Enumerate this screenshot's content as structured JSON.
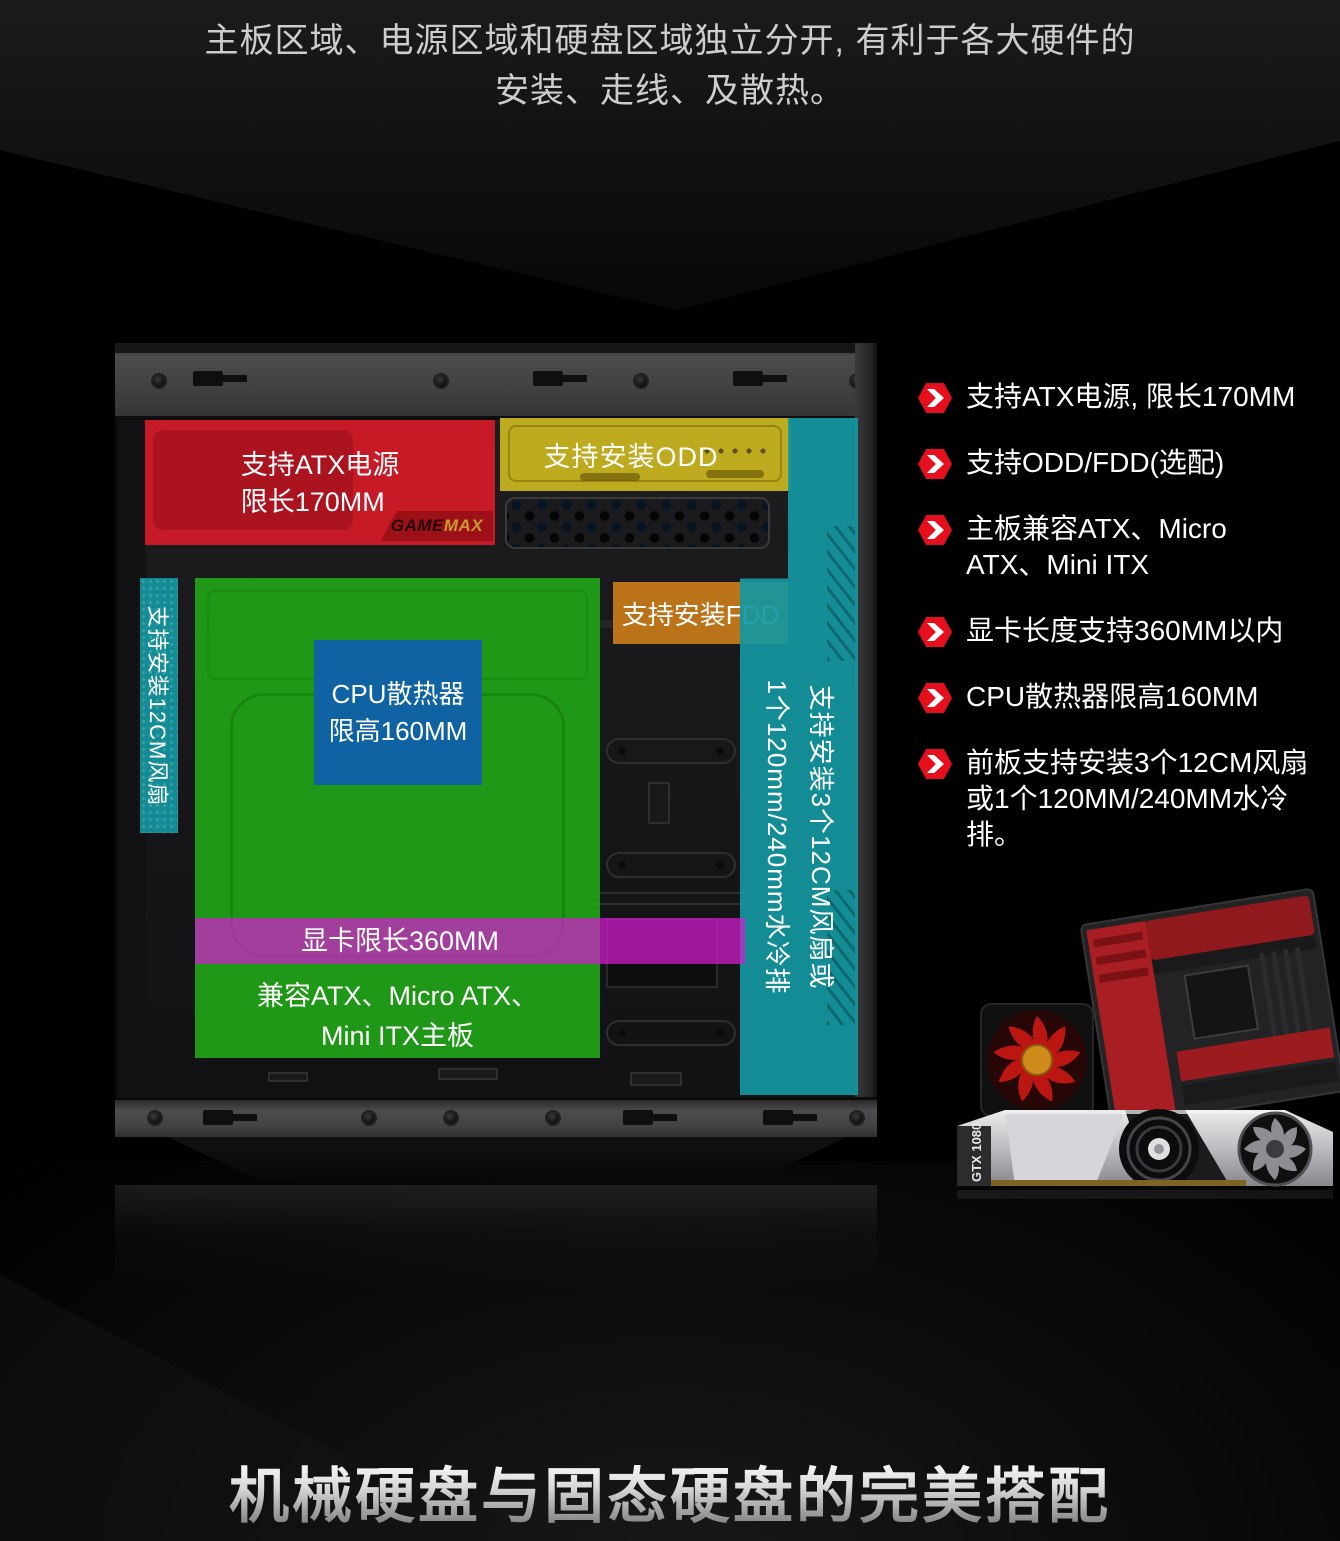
{
  "header": {
    "line1": "主板区域、电源区域和硬盘区域独立分开, 有利于各大硬件的",
    "line2": "安装、走线、及散热。"
  },
  "case_diagram": {
    "psu_region": {
      "line1": "支持ATX电源",
      "line2": "限长170MM",
      "color": "#d01a28"
    },
    "odd_region": {
      "label": "支持安装ODD",
      "color": "#cab51e"
    },
    "fdd_region": {
      "label": "支持安装FDD",
      "color": "#c4781a"
    },
    "motherboard_region": {
      "line1": "兼容ATX、Micro ATX、",
      "line2": "Mini ITX主板",
      "color": "#20a218"
    },
    "cpu_region": {
      "line1": "CPU散热器",
      "line2": "限高160MM",
      "color": "#1061a8"
    },
    "gpu_strip": {
      "label": "显卡限长360MM",
      "color": "#b32bad"
    },
    "left_fan_strip": {
      "label": "支持安装12CM风扇",
      "color": "#1497a1"
    },
    "front_fan_strip": {
      "line1": "支持安装3个12CM风扇或",
      "line2": "1个120mm/240mm水冷排",
      "color": "#1497a1"
    },
    "brand_badge": {
      "part1": "GAME",
      "part2": "MAX"
    }
  },
  "features": {
    "bullet_color": "#e50f1e",
    "items": [
      {
        "text": "支持ATX电源, 限长170MM"
      },
      {
        "text": "支持ODD/FDD(选配)"
      },
      {
        "text": "主板兼容ATX、Micro ATX、Mini ITX"
      },
      {
        "text": "显卡长度支持360MM以内"
      },
      {
        "text": "CPU散热器限高160MM"
      },
      {
        "text": "前板支持安装3个12CM风扇或1个120MM/240MM水冷排。"
      }
    ]
  },
  "hardware_photo": {
    "gpu_label": "GTX 1080"
  },
  "footer": {
    "title": "机械硬盘与固态硬盘的完美搭配"
  }
}
